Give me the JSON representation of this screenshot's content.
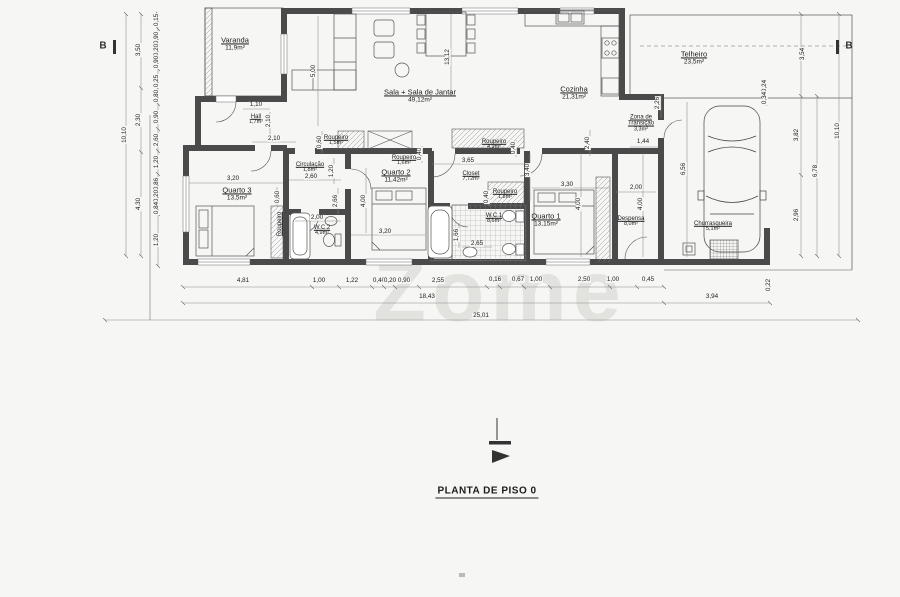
{
  "title": "PLANTA DE PISO 0",
  "watermark": "Zome",
  "markers": {
    "left": "B",
    "right": "B"
  },
  "rooms": [
    {
      "name": "Varanda",
      "area": "11,9m²",
      "x": 235,
      "y": 44
    },
    {
      "name": "Hall",
      "area": "1,7m²",
      "x": 256,
      "y": 120,
      "small": true
    },
    {
      "name": "Sala + Sala de Jantar",
      "area": "49,12m²",
      "x": 420,
      "y": 96
    },
    {
      "name": "Cozinha",
      "area": "21,31m²",
      "x": 574,
      "y": 93
    },
    {
      "name": "Telheiro",
      "area": "23,5m²",
      "x": 694,
      "y": 58
    },
    {
      "name": "Zona de Transição",
      "area": "3,3m²",
      "x": 641,
      "y": 124,
      "small": true,
      "wrap": true
    },
    {
      "name": "Circulação",
      "area": "1,8m²",
      "x": 310,
      "y": 168,
      "small": true
    },
    {
      "name": "Roupeiro",
      "area": "1,5m²",
      "x": 336,
      "y": 141,
      "small": true
    },
    {
      "name": "Roupeiro",
      "area": "1,6m²",
      "x": 404,
      "y": 161,
      "small": true
    },
    {
      "name": "Roupeiro",
      "area": "4,9m²",
      "x": 494,
      "y": 145,
      "small": true
    },
    {
      "name": "Roupeiro",
      "area": "1,8m²",
      "x": 505,
      "y": 195,
      "small": true
    },
    {
      "name": "Closet",
      "area": "7,72m²",
      "x": 471,
      "y": 177,
      "small": true
    },
    {
      "name": "W.C.1",
      "area": "8,6m²",
      "x": 494,
      "y": 219,
      "small": true
    },
    {
      "name": "W.C.2",
      "area": "4,9m²",
      "x": 322,
      "y": 231,
      "small": true
    },
    {
      "name": "Quarto 1",
      "area": "13,15m²",
      "x": 546,
      "y": 220
    },
    {
      "name": "Quarto 2",
      "area": "11,42m²",
      "x": 396,
      "y": 176
    },
    {
      "name": "Quarto 3",
      "area": "13,5m²",
      "x": 237,
      "y": 194
    },
    {
      "name": "Despensa",
      "area": "8,0m²",
      "x": 631,
      "y": 222,
      "small": true
    },
    {
      "name": "Churrasqueira",
      "area": "5,1m²",
      "x": 713,
      "y": 227,
      "small": true
    },
    {
      "name": "Roupeiro",
      "area": "",
      "x": 280,
      "y": 224,
      "r": -90,
      "small": true
    }
  ],
  "dims": [
    {
      "t": "10,10",
      "x": 125,
      "y": 135,
      "r": -90
    },
    {
      "t": "3,50",
      "x": 139,
      "y": 50,
      "r": -90
    },
    {
      "t": "2,30",
      "x": 139,
      "y": 120,
      "r": -90
    },
    {
      "t": "4,30",
      "x": 139,
      "y": 204,
      "r": -90
    },
    {
      "t": "0,15",
      "x": 157,
      "y": 20,
      "r": -90
    },
    {
      "t": "0,90",
      "x": 157,
      "y": 38,
      "r": -90
    },
    {
      "t": "0,20",
      "x": 157,
      "y": 50,
      "r": -90
    },
    {
      "t": "0,90",
      "x": 157,
      "y": 62,
      "r": -90
    },
    {
      "t": "0,25",
      "x": 157,
      "y": 81,
      "r": -90
    },
    {
      "t": "0,80",
      "x": 157,
      "y": 96,
      "r": -90
    },
    {
      "t": "0,90",
      "x": 157,
      "y": 117,
      "r": -90
    },
    {
      "t": "2,60",
      "x": 157,
      "y": 140,
      "r": -90
    },
    {
      "t": "1,20",
      "x": 157,
      "y": 162,
      "r": -90
    },
    {
      "t": "0,86",
      "x": 157,
      "y": 184,
      "r": -90
    },
    {
      "t": "0,20",
      "x": 157,
      "y": 196,
      "r": -90
    },
    {
      "t": "0,84",
      "x": 157,
      "y": 208,
      "r": -90
    },
    {
      "t": "1,20",
      "x": 157,
      "y": 240,
      "r": -90
    },
    {
      "t": "3,54",
      "x": 803,
      "y": 54,
      "r": -90
    },
    {
      "t": "3,82",
      "x": 797,
      "y": 135,
      "r": -90
    },
    {
      "t": "2,96",
      "x": 797,
      "y": 215,
      "r": -90
    },
    {
      "t": "6,78",
      "x": 816,
      "y": 171,
      "r": -90
    },
    {
      "t": "10,10",
      "x": 838,
      "y": 131,
      "r": -90
    },
    {
      "t": "4,81",
      "x": 243,
      "y": 281
    },
    {
      "t": "1,00",
      "x": 319,
      "y": 281
    },
    {
      "t": "1,22",
      "x": 352,
      "y": 281
    },
    {
      "t": "0,40",
      "x": 379,
      "y": 281
    },
    {
      "t": "0,20",
      "x": 390,
      "y": 281
    },
    {
      "t": "0,90",
      "x": 404,
      "y": 281
    },
    {
      "t": "2,55",
      "x": 438,
      "y": 281
    },
    {
      "t": "0,16",
      "x": 495,
      "y": 280
    },
    {
      "t": "0,67",
      "x": 518,
      "y": 280
    },
    {
      "t": "1,00",
      "x": 536,
      "y": 280
    },
    {
      "t": "2,50",
      "x": 584,
      "y": 280
    },
    {
      "t": "1,00",
      "x": 613,
      "y": 280
    },
    {
      "t": "0,45",
      "x": 648,
      "y": 280
    },
    {
      "t": "3,94",
      "x": 712,
      "y": 297
    },
    {
      "t": "0,22",
      "x": 769,
      "y": 285,
      "r": -90
    },
    {
      "t": "18,43",
      "x": 427,
      "y": 297
    },
    {
      "t": "25,01",
      "x": 481,
      "y": 316
    },
    {
      "t": "1,10",
      "x": 256,
      "y": 105
    },
    {
      "t": "2,10",
      "x": 269,
      "y": 121,
      "r": -90
    },
    {
      "t": "2,10",
      "x": 274,
      "y": 139
    },
    {
      "t": "0,60",
      "x": 320,
      "y": 142,
      "r": -90
    },
    {
      "t": "5,00",
      "x": 314,
      "y": 71,
      "r": -90
    },
    {
      "t": "13,12",
      "x": 448,
      "y": 57,
      "r": -90
    },
    {
      "t": "2,26",
      "x": 658,
      "y": 103,
      "r": -90
    },
    {
      "t": "1,44",
      "x": 643,
      "y": 142
    },
    {
      "t": "0,24",
      "x": 765,
      "y": 86,
      "r": -90
    },
    {
      "t": "0,34",
      "x": 765,
      "y": 98,
      "r": -90
    },
    {
      "t": "2,40",
      "x": 588,
      "y": 143,
      "r": -90
    },
    {
      "t": "6,56",
      "x": 684,
      "y": 169,
      "r": -90
    },
    {
      "t": "3,20",
      "x": 233,
      "y": 179
    },
    {
      "t": "0,60",
      "x": 278,
      "y": 197,
      "r": -90
    },
    {
      "t": "2,60",
      "x": 311,
      "y": 177
    },
    {
      "t": "1,20",
      "x": 332,
      "y": 171,
      "r": -90
    },
    {
      "t": "2,66",
      "x": 336,
      "y": 201,
      "r": -90
    },
    {
      "t": "2,00",
      "x": 317,
      "y": 218
    },
    {
      "t": "3,20",
      "x": 385,
      "y": 232
    },
    {
      "t": "4,00",
      "x": 364,
      "y": 201,
      "r": -90
    },
    {
      "t": "0,40",
      "x": 420,
      "y": 154,
      "r": -90
    },
    {
      "t": "3,65",
      "x": 468,
      "y": 161
    },
    {
      "t": "3,40",
      "x": 528,
      "y": 170,
      "r": -90
    },
    {
      "t": "0,40",
      "x": 514,
      "y": 148,
      "r": -90
    },
    {
      "t": "0,40",
      "x": 487,
      "y": 197,
      "r": -90
    },
    {
      "t": "1,66",
      "x": 457,
      "y": 235,
      "r": -90
    },
    {
      "t": "2,65",
      "x": 477,
      "y": 244
    },
    {
      "t": "3,30",
      "x": 567,
      "y": 185
    },
    {
      "t": "4,00",
      "x": 579,
      "y": 204,
      "r": -90
    },
    {
      "t": "2,00",
      "x": 636,
      "y": 188
    },
    {
      "t": "4,00",
      "x": 641,
      "y": 204,
      "r": -90
    }
  ]
}
